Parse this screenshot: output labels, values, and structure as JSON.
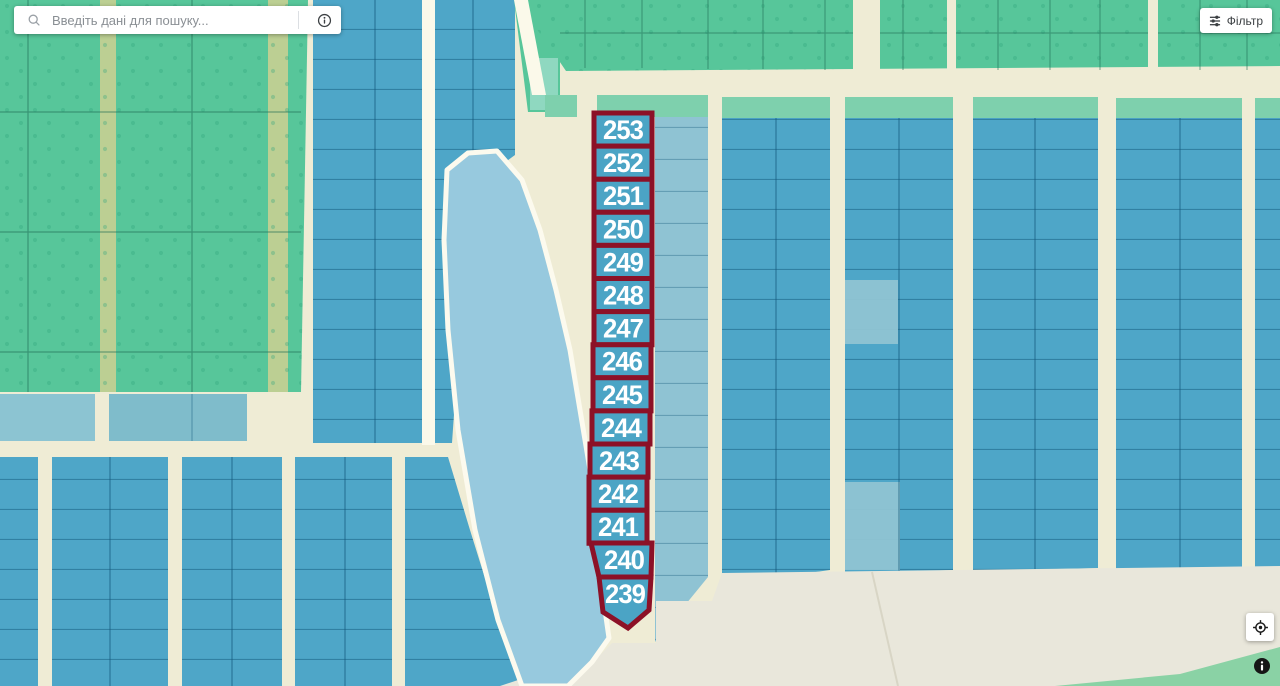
{
  "search_bar": {
    "placeholder": "Введіть дані для пошуку...",
    "magnifier_icon": "search-icon",
    "info_icon": "info-icon"
  },
  "filter_button": {
    "label": "Фільтр",
    "icon": "tune-icon"
  },
  "map": {
    "highlighted_parcels": {
      "numbers": [
        "253",
        "252",
        "251",
        "250",
        "249",
        "248",
        "247",
        "246",
        "245",
        "244",
        "243",
        "242",
        "241",
        "240",
        "239"
      ]
    },
    "colors": {
      "highlight_outline": "#8C1127",
      "highlight_fill": "#4BA4C5",
      "parcel_blue": "#4EA6C8",
      "parcel_light_blue": "#8FC3D3",
      "water": "#97C9DE",
      "field_green": "#57C69A",
      "band_teal": "#7ED0AD",
      "road_beige": "#EFECD5",
      "label_color": "#FFFFFF"
    }
  },
  "map_controls": {
    "locate_icon": "my-location-icon",
    "info_icon": "info-circle-icon"
  }
}
